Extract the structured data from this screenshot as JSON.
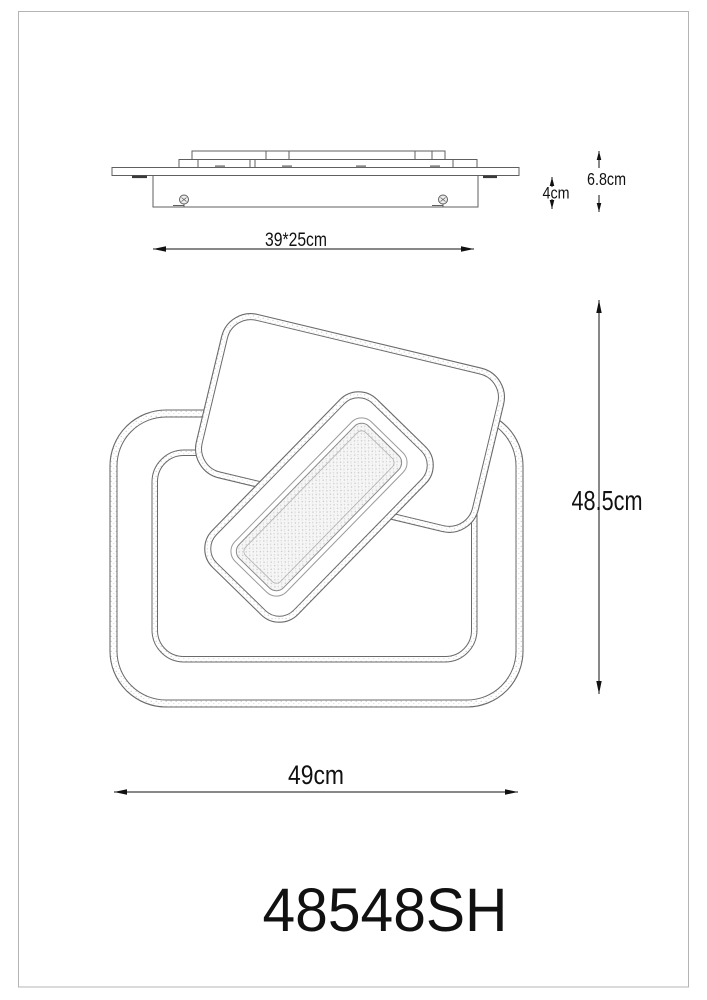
{
  "page": {
    "background": "#ffffff",
    "frame_border_color": "#b4b4b4"
  },
  "drawing": {
    "line_color": "#5f5f5f",
    "dim_color": "#111111",
    "model_color": "#111111",
    "stipple_color": "#c9c9c9"
  },
  "side_view": {
    "width_dim": {
      "label": "39*25cm"
    },
    "bracket_height_dim": {
      "label": "4cm"
    },
    "total_height_dim": {
      "label": "6.8cm"
    }
  },
  "front_view": {
    "height_dim": {
      "label": "48.5cm"
    },
    "width_dim": {
      "label": "49cm"
    }
  },
  "footer": {
    "model_number": "48548SH"
  }
}
